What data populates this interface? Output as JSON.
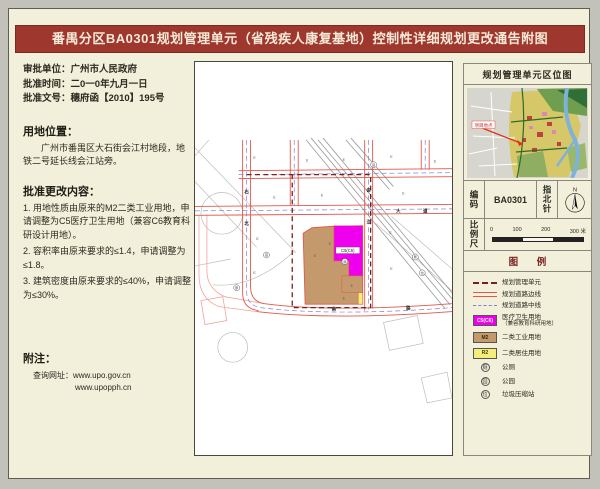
{
  "title": "番禺分区BA0301规划管理单元（省残疾人康复基地）控制性详细规划更改通告附图",
  "info": {
    "approval_unit": "审批单位：广州市人民政府",
    "approval_time": "批准时间：二0一0年九月一日",
    "approval_doc": "批准文号：穗府函【2010】195号",
    "location_heading": "用地位置：",
    "location_text": "广州市番禺区大石街会江村地段，地铁二号延长线会江站旁。",
    "changes_heading": "批准更改内容：",
    "changes": [
      "1. 用地性质由原来的M2二类工业用地，申请调整为C5医疗卫生用地（兼容C6教育科研设计用地）。",
      "2. 容积率由原来要求的≤1.4，申请调整为≤1.8。",
      "3. 建筑密度由原来要求的≤40%，申请调整为≤30%。"
    ],
    "note_heading": "附注：",
    "note_line1": "查询网址：www.upo.gov.cn",
    "note_line2": "www.upopph.cn"
  },
  "map": {
    "parcel_label": "C5(C6)",
    "parcel_code": "E",
    "road_chars": {
      "c1": "石",
      "c2": "北",
      "c3": "会",
      "c4": "江",
      "c5": "大",
      "c6": "道",
      "c7": "南",
      "c8": "路"
    },
    "symbols": {
      "s1": "厕",
      "s2": "园",
      "s3": "垃"
    }
  },
  "sidebar": {
    "locmap_title": "规划管理单元区位图",
    "project_label": "项目地点",
    "code_label": "编码",
    "code_value": "BA0301",
    "north_label": "指北针",
    "north_n": "N",
    "scale_label": "比例尺",
    "scale_ticks": [
      "0",
      "100",
      "200",
      "300 米"
    ],
    "legend_title": "图 例",
    "legend": [
      {
        "label": "规划管理单元"
      },
      {
        "label": "规划道路边线"
      },
      {
        "label": "规划道路中线"
      },
      {
        "swatch": "C5(C6)",
        "label": "医疗卫生用地",
        "label2": "（兼容教育科研用地）"
      },
      {
        "swatch": "M2",
        "label": "二类工业用地"
      },
      {
        "swatch": "R2",
        "label": "二类居住用地"
      },
      {
        "sym": "厕",
        "label": "公厕"
      },
      {
        "sym": "园",
        "label": "公园"
      },
      {
        "sym": "垃",
        "label": "垃圾压缩站"
      }
    ]
  },
  "colors": {
    "title_bg": "#9e382e",
    "boundary_dark_red": "#7a1f1f",
    "road_red": "#e2574a",
    "centerline_blue": "#8080cc",
    "c5_magenta": "#ee00ee",
    "m2_tan": "#c49a6c",
    "r2_yellow": "#f5ef7a",
    "page_bg": "#f2efda"
  }
}
